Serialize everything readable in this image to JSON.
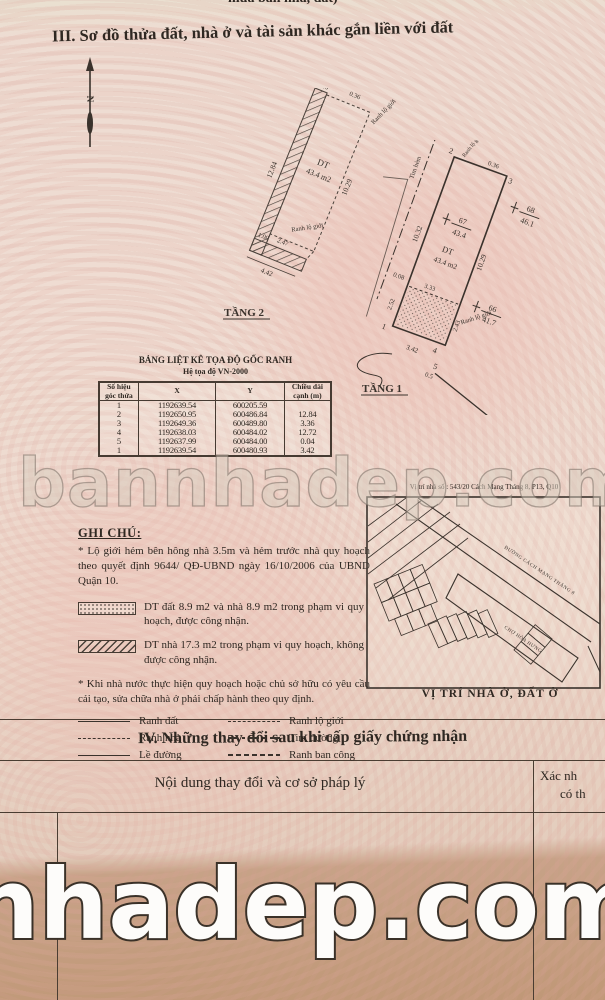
{
  "page": {
    "top_clipped_text": "mua bán nhà, đất)",
    "section3_title": "III. Sơ đồ thửa đất, nhà ở và tài sản khác gắn liền với đất",
    "watermark_mid": "bannhadep.com",
    "watermark_bottom": "nhadep.com"
  },
  "plan2": {
    "name": "TẦNG 2",
    "area_label": "DT",
    "area_value": "43.4 m2",
    "edge_label_top": "Ranh lộ giới",
    "edge_label_mid": "Ranh lộ giới",
    "dims": {
      "left": "12.84",
      "top": "1.00",
      "top_right": "0.36",
      "right": "10.29",
      "inner_a": "1.00",
      "inner_b": "2.47",
      "bottom": "4.42"
    }
  },
  "plan1": {
    "name": "TẦNG 1",
    "area_label": "DT",
    "area_value": "43.4 m2",
    "tim_hem": "Tim hẻm",
    "edge_label_top": "Ranh lộ giới",
    "edge_label_bottom": "Ranh lộ giới",
    "corners": [
      "2",
      "3",
      "1",
      "4",
      "5"
    ],
    "marks": [
      {
        "id": "68",
        "val": "46.1"
      },
      {
        "id": "67",
        "val": "43.4"
      },
      {
        "id": "66",
        "val": "41.7"
      }
    ],
    "dims": {
      "top": "1.75",
      "top_right": "0.36",
      "right": "10.29",
      "left": "10.32",
      "left2": "0.08",
      "left3": "2.52",
      "inner": "3.33",
      "bottom": "3.42",
      "bottom_right": "2.43",
      "corner5": "0.5"
    }
  },
  "coord_table": {
    "title": "BẢNG LIỆT KÊ TỌA ĐỘ GỐC RANH",
    "subtitle": "Hệ tọa độ VN-2000",
    "headers": [
      "Số hiệu góc thửa",
      "X",
      "Y",
      "Chiều dài cạnh (m)"
    ],
    "rows": [
      [
        "1",
        "1192639.54",
        "600205.59",
        ""
      ],
      [
        "2",
        "1192650.95",
        "600486.84",
        "12.84"
      ],
      [
        "3",
        "1192649.36",
        "600489.80",
        "3.36"
      ],
      [
        "4",
        "1192638.03",
        "600484.02",
        "12.72"
      ],
      [
        "5",
        "1192637.99",
        "600484.00",
        "0.04"
      ],
      [
        "1",
        "1192639.54",
        "600480.93",
        "3.42"
      ]
    ]
  },
  "notes": {
    "heading": "GHI CHÚ:",
    "note1": "* Lộ giới hẻm bên hông nhà 3.5m và hẻm trước nhà quy hoạch theo quyết định  9644/ QĐ-UBND ngày 16/10/2006 của UBND Quận 10.",
    "hatch_items": [
      {
        "text": "DT đất 8.9 m2 và nhà 8.9 m2 trong phạm vi quy hoạch, được công nhận."
      },
      {
        "text": "DT nhà 17.3 m2 trong phạm vi quy hoạch, không được công nhận."
      }
    ],
    "note2": "* Khi nhà nước thực hiện quy hoạch hoặc chủ sở hữu có yêu cầu cải tạo, sửa chữa  nhà ở phải chấp hành theo quy định.",
    "legend": [
      {
        "label": "Ranh đất"
      },
      {
        "label": "Ranh lộ giới"
      },
      {
        "label": "Ranh nhà"
      },
      {
        "label": "Tim đường"
      },
      {
        "label": "Lề đường"
      },
      {
        "label": "Ranh ban công"
      }
    ]
  },
  "map": {
    "title": "Vị trí nhà số : 543/20 Cách Mạng Tháng 8, P13, Q10",
    "street_label": "ĐƯỜNG CÁCH MẠNG THÁNG 8",
    "block_label": "CHỢ HÒA HƯNG",
    "caption": "VỊ TRÍ NHÀ Ở, ĐẤT Ở"
  },
  "section4": {
    "title": "IV. Những thay đổi sau khi cấp giấy chứng nhận",
    "col1": "Nội dung thay đổi và cơ sở pháp lý",
    "col2_line1": "Xác nh",
    "col2_line2": "có th"
  }
}
